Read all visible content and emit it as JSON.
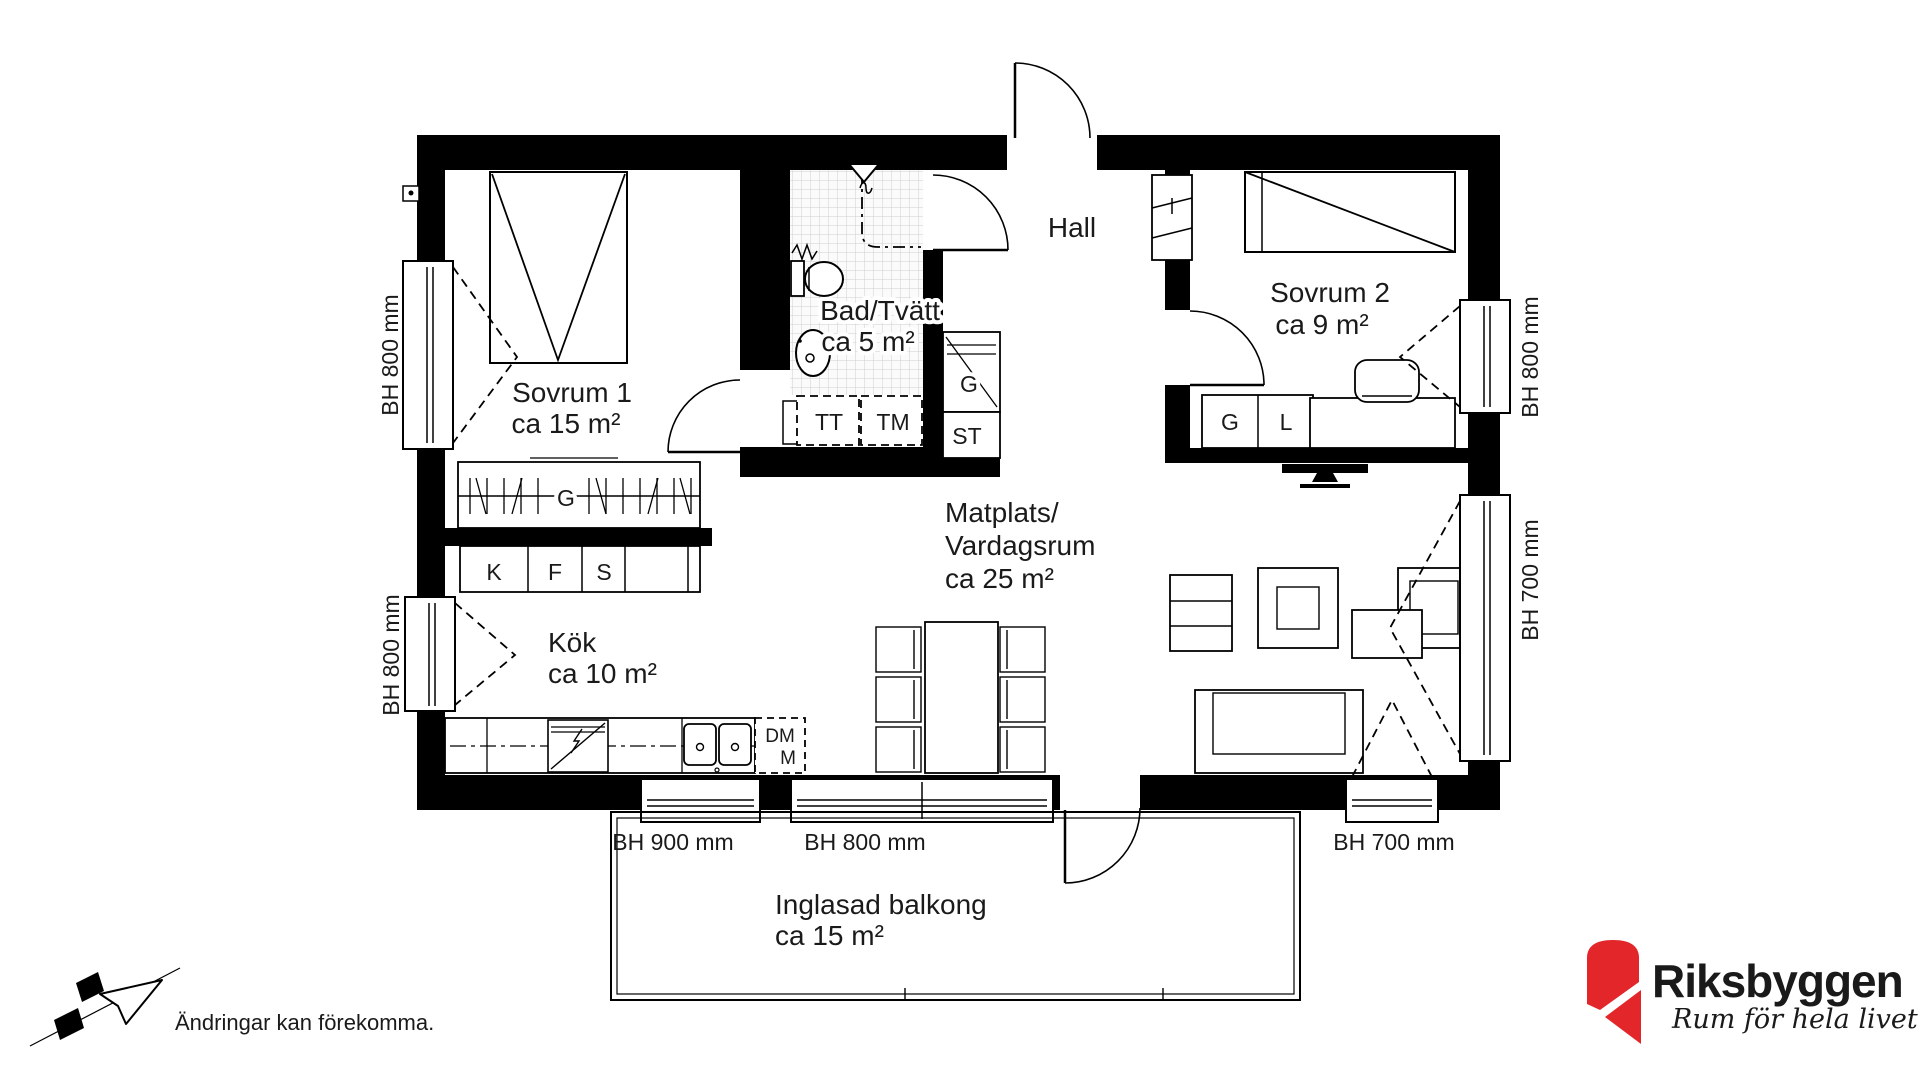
{
  "rooms": {
    "sovrum1": {
      "name": "Sovrum 1",
      "area": "ca 15 m²"
    },
    "bad": {
      "name": "Bad/Tvätt",
      "area": "ca 5 m²"
    },
    "hall": {
      "name": "Hall"
    },
    "sovrum2": {
      "name": "Sovrum 2",
      "area": "ca 9 m²"
    },
    "matplats": {
      "name_line1": "Matplats/",
      "name_line2": "Vardagsrum",
      "area": "ca 25 m²"
    },
    "kok": {
      "name": "Kök",
      "area": "ca 10 m²"
    },
    "balkong": {
      "name": "Inglasad balkong",
      "area": "ca 15 m²"
    }
  },
  "fixtures": {
    "wardrobe": "G",
    "fridge": "K",
    "freezer": "F",
    "pantry": "S",
    "dryer": "TT",
    "washer": "TM",
    "hall_closet": "G",
    "cleaning_closet": "ST",
    "sovrum2_wardrobe": "G",
    "sovrum2_linen": "L",
    "dishwasher": "DM",
    "micro": "M"
  },
  "windows": {
    "left_top": "BH 800 mm",
    "left_bottom": "BH 800 mm",
    "right_top": "BH 800 mm",
    "right_bottom": "BH 700 mm",
    "bottom_left": "BH 900 mm",
    "bottom_center": "BH 800 mm",
    "bottom_right": "BH 700 mm"
  },
  "footer": {
    "disclaimer": "Ändringar kan förekomma."
  },
  "logo": {
    "name": "Riksbyggen",
    "tagline": "Rum för hela livet"
  },
  "colors": {
    "logo_red": "#e2262a",
    "logo_gray": "#8d8d8d"
  }
}
